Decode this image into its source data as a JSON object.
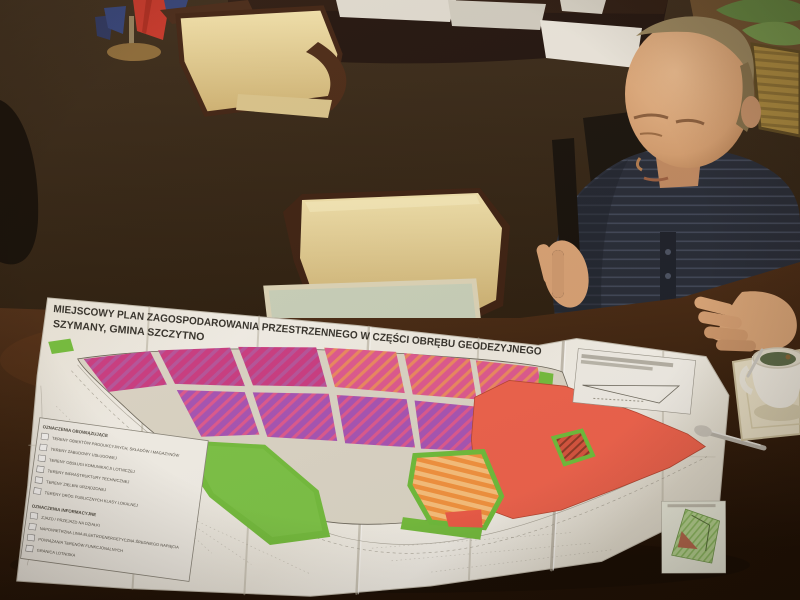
{
  "scene": {
    "setting": "Office meeting room photographed from above a dark wooden conference table; a man studies a large unfolded zoning plan",
    "objects": [
      "unfolded paper zoning map",
      "man in dark striped shirt reading the map",
      "cream upholstered wooden chairs",
      "dark wooden desk with documents",
      "flag stand with red and blue flags",
      "white teacup on cream saucer with teaspoon",
      "pale green glass desk pad",
      "potted plant leaves"
    ]
  },
  "map": {
    "title_line1": "MIEJSCOWY PLAN ZAGOSPODAROWANIA PRZESTRZENNEGO W CZĘŚCI OBRĘBU GEODEZYJNEGO",
    "title_line2": "SZYMANY, GMINA SZCZYTNO",
    "legend": {
      "heading_primary": "OZNACZENIA OBOWIĄZUJĄCE",
      "heading_info": "OZNACZENIA INFORMACYJNE",
      "zone_items": [
        {
          "label": "TERENY OBIEKTÓW PRODUKCYJNYCH, SKŁADÓW I MAGAZYNÓW"
        },
        {
          "label": "TERENY ZABUDOWY USŁUGOWEJ"
        },
        {
          "label": "TERENY OBSŁUGI KOMUNIKACJI LOTNICZEJ"
        },
        {
          "label": "TERENY INFRASTRUKTURY TECHNICZNEJ"
        },
        {
          "label": "TERENY ZIELENI URZĄDZONEJ"
        },
        {
          "label": "TERENY DRÓG PUBLICZNYCH KLASY LOKALNEJ"
        }
      ],
      "info_items": [
        {
          "label": "ZJAZD / PRZEJAZD NA DZIAŁKI"
        },
        {
          "label": "NAPOWIETRZNA LINIA ELEKTROENERGETYCZNA ŚREDNIEGO NAPIĘCIA"
        },
        {
          "label": "POWIĄZANIA TERENÓW FUNKCJONALNYCH"
        },
        {
          "label": "GRANICA LOTNISKA"
        }
      ]
    },
    "colors": {
      "industrial_magenta": "#cc3d85",
      "industrial_stripe": "#b8559f",
      "mixed_pink": "#e05a92",
      "mixed_stripe_orange": "#ee8a63",
      "service_purple": "#a855b8",
      "airport_orange": "#f59440",
      "airport_orange_light": "#fbc27e",
      "technical_red": "#f0634e",
      "greenery_green": "#74bf3f",
      "road_beige": "#ddd8ca",
      "paper_white": "#f2efe8"
    }
  }
}
